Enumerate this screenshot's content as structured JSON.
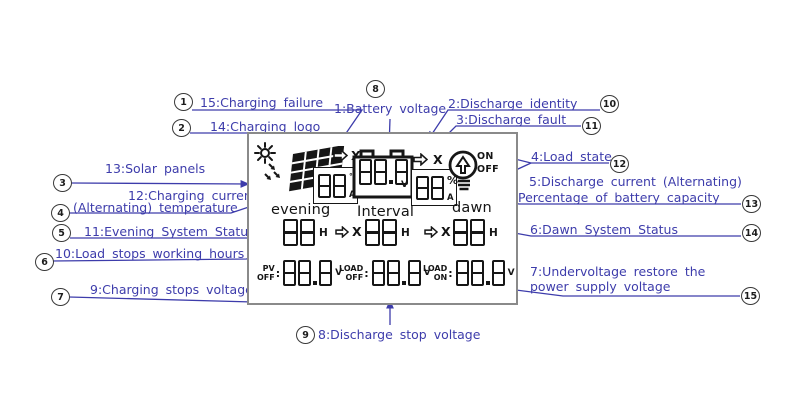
{
  "colors": {
    "annotation": "#3d3cab",
    "ink": "#161616",
    "lcd_border": "#8a8a8a"
  },
  "callouts": {
    "c1": {
      "num": "1",
      "label": "15:Charging failure"
    },
    "c2": {
      "num": "2",
      "label": "14:Charging logo"
    },
    "c3": {
      "num": "3",
      "label": "13:Solar panels"
    },
    "c4": {
      "num": "4",
      "label1": "12:Charging current",
      "label2": "(Alternating) temperature"
    },
    "c5": {
      "num": "5",
      "label": "11:Evening System Status"
    },
    "c6": {
      "num": "6",
      "label": "10:Load stops working hours"
    },
    "c7": {
      "num": "7",
      "label": "9:Charging stops voltage"
    },
    "c8": {
      "num": "8",
      "label": "1:Battery voltage"
    },
    "c9": {
      "num": "9",
      "label": "8:Discharge stop voltage"
    },
    "c10": {
      "num": "10",
      "label": "2:Discharge identity"
    },
    "c11": {
      "num": "11",
      "label": "3:Discharge fault"
    },
    "c12": {
      "num": "12",
      "label": "4:Load state"
    },
    "c13": {
      "num": "13",
      "label1": "5:Discharge current (Alternating)",
      "label2": "Percentage of battery capacity"
    },
    "c14": {
      "num": "14",
      "label": "6:Dawn System Status"
    },
    "c15": {
      "num": "15",
      "label1": "7:Undervoltage restore the",
      "label2": "power supply voltage"
    }
  },
  "lcd": {
    "x_mark": "X",
    "charge_display": {
      "value": "88",
      "unit_top": "°C",
      "unit_bottom": "A"
    },
    "battery_display": {
      "value": "88.8",
      "unit": "V"
    },
    "discharge_display": {
      "value": "88",
      "unit_top": "%",
      "unit_bottom": "A"
    },
    "load_state": {
      "on": "ON",
      "off": "OFF"
    },
    "timers": [
      {
        "title": "evening",
        "value": "88",
        "unit": "H"
      },
      {
        "title": "Interval",
        "value": "88",
        "unit": "H"
      },
      {
        "title": "dawn",
        "value": "88",
        "unit": "H"
      }
    ],
    "voltages": [
      {
        "line1": "PV",
        "line2": "OFF",
        "colon": ":",
        "value": "88.8",
        "unit": "V"
      },
      {
        "line1": "LOAD",
        "line2": "OFF",
        "colon": ":",
        "value": "88.8",
        "unit": "V"
      },
      {
        "line1": "LOAD",
        "line2": "ON",
        "colon": ":",
        "value": "88.8",
        "unit": "V"
      }
    ]
  }
}
